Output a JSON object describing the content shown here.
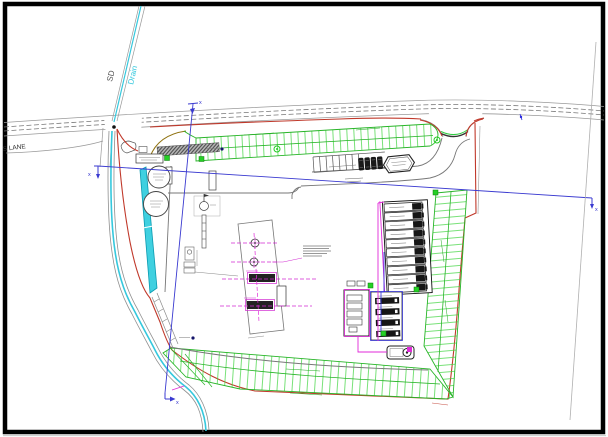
{
  "drawing": {
    "labels": {
      "lane": "S LANE",
      "drain_abbrev": "SD",
      "drain": "Drain",
      "section_marker": "x"
    },
    "colors": {
      "boundary_red": "#c0392b",
      "landscaping_green": "#28b428",
      "water_cyan": "#35c8dd",
      "section_blue": "#3a3ad0",
      "services_magenta": "#e02ad8",
      "road_grey": "#8c8c8c"
    }
  }
}
